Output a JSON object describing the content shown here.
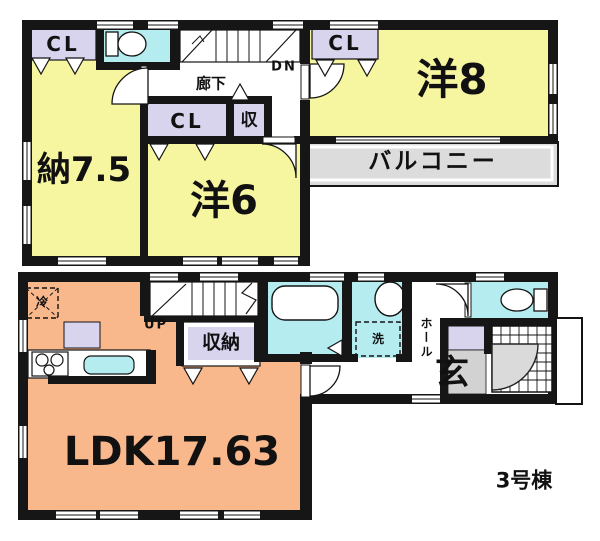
{
  "title": "3号棟 間取り図 (floor plan)",
  "colors": {
    "wall": "#161616",
    "room_yellow": "#f6f5a0",
    "water_cyan": "#b4ecf0",
    "closet_lavender": "#d8d4ee",
    "ldk_orange": "#f9b78c",
    "balcony_gray": "#dcdcdc",
    "entrance_gray": "#d2d2d2",
    "door_swing_gray": "#dadada"
  },
  "floor2": {
    "closet_top_left": "CL",
    "closet_mid": "CL",
    "closet_small": "収",
    "closet_top_right": "CL",
    "storage_room": "納7.5",
    "western_room_6": "洋6",
    "western_room_8": "洋8",
    "corridor": "廊下",
    "stairs_down": "DN",
    "balcony": "バルコニー"
  },
  "floor1": {
    "ldk": "LDK17.63",
    "stairs_up": "UP",
    "storage": "収納",
    "refrigerator": "冷",
    "washer": "洗",
    "hall": "ホール",
    "entrance": "玄",
    "building": "3号棟"
  }
}
